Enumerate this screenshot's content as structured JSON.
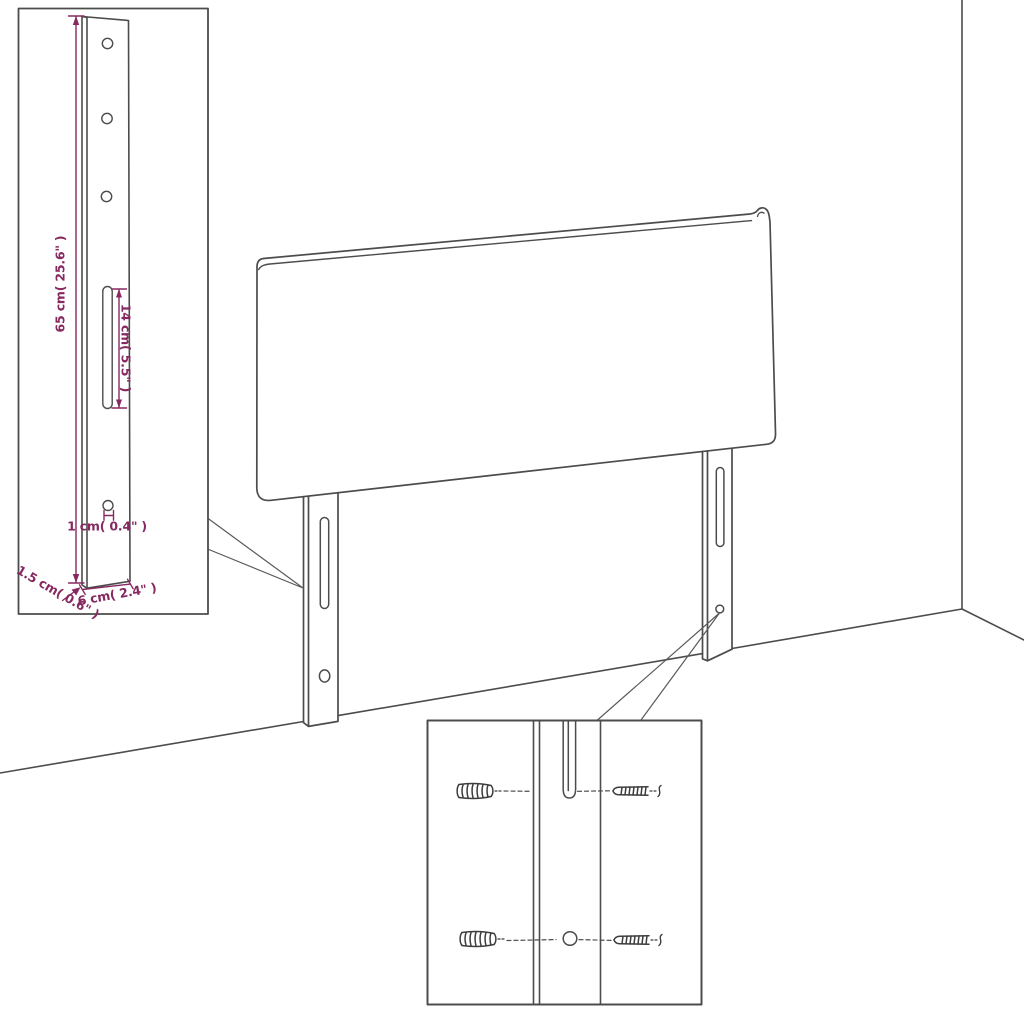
{
  "title": "Headboard assembly dimension diagram",
  "colors": {
    "line": "#4c4c4c",
    "dimension": "#862960",
    "background": "#ffffff"
  },
  "labels": {
    "bracket_height": "65 cm( 25.6\" )",
    "slot_length": "14 cm( 5.5\" )",
    "hole_diameter": "1 cm( 0.4\" )",
    "side_thickness": "1.5 cm( 0.6\" )",
    "bracket_width": "6 cm( 2.4\" )"
  }
}
